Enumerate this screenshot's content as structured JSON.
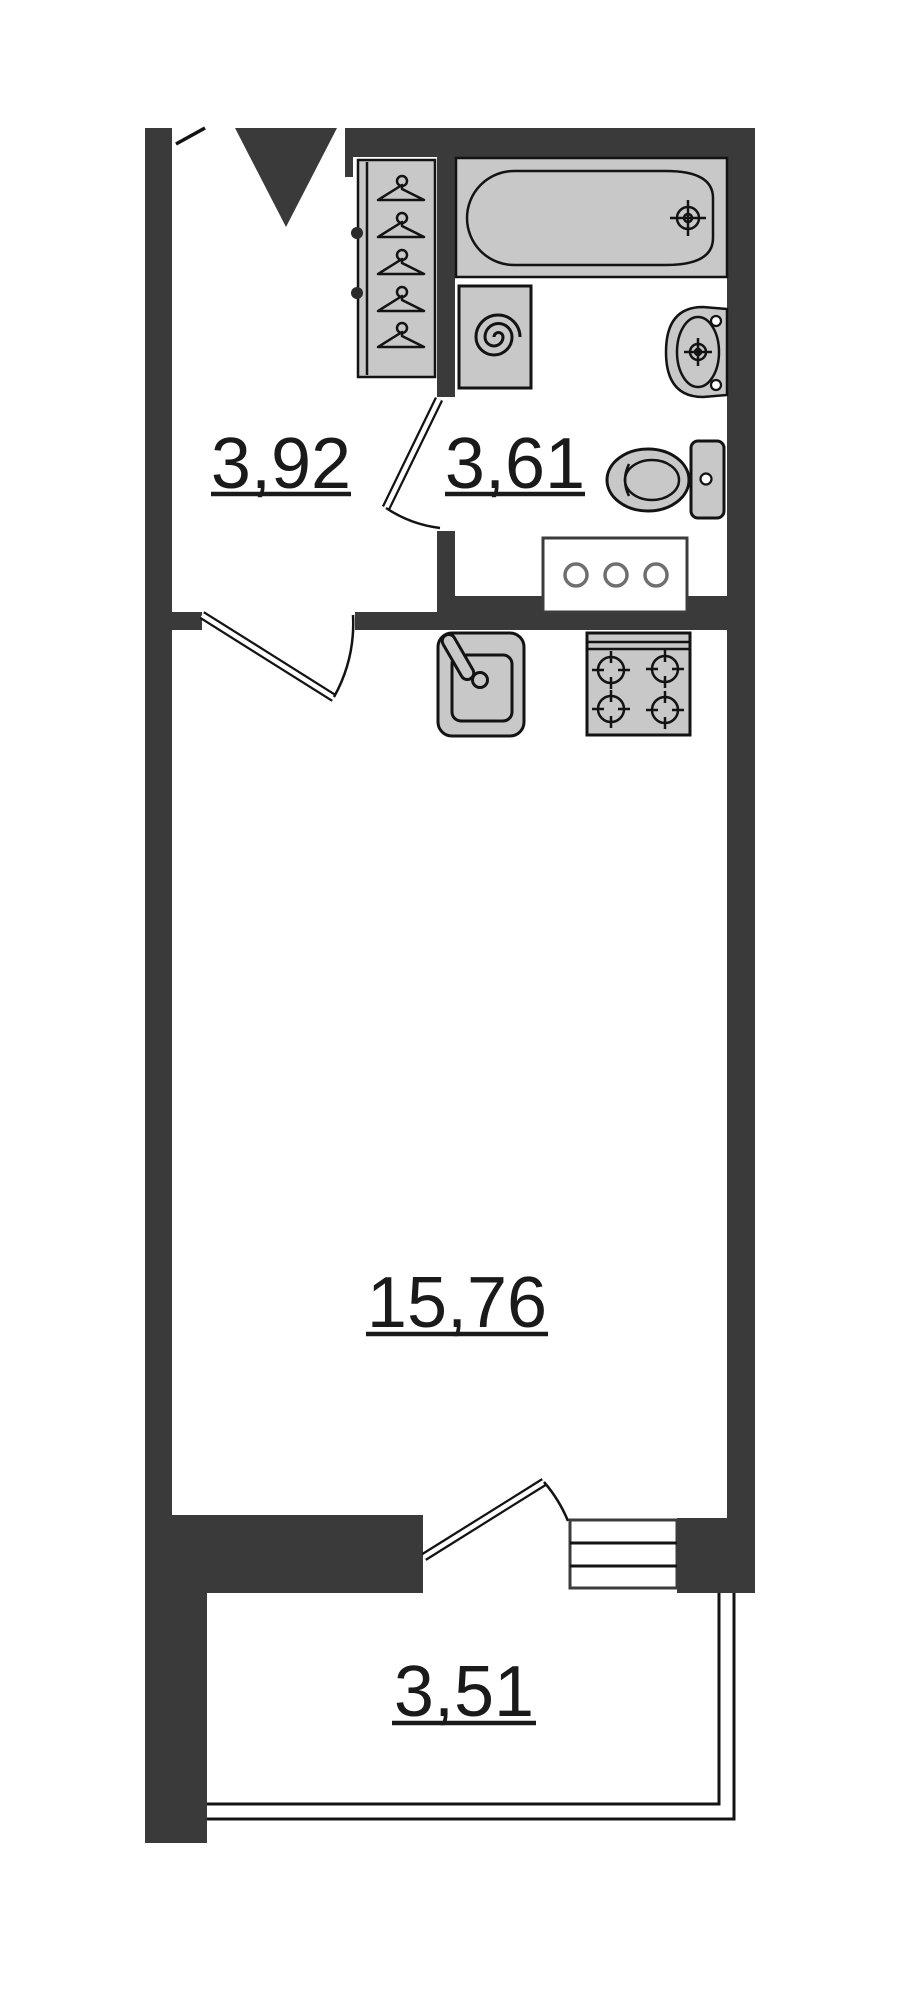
{
  "plan": {
    "kind": "studio apartment floor plan",
    "rooms": [
      {
        "name": "hallway",
        "area_label": "3,92"
      },
      {
        "name": "bathroom",
        "area_label": "3,61"
      },
      {
        "name": "living-room",
        "area_label": "15,76"
      },
      {
        "name": "balcony",
        "area_label": "3,51"
      }
    ],
    "fixtures": [
      "entrance-arrow",
      "entrance-door-leaf",
      "wardrobe-hangers",
      "bathtub",
      "washing-machine",
      "wash-basin",
      "toilet",
      "vanity-counter",
      "kitchen-sink",
      "cooktop",
      "balcony-window",
      "balcony-railing",
      "bathroom-door-swing",
      "living-room-door-swing",
      "balcony-door-swing"
    ],
    "colors": {
      "wall": "#3a3a3a",
      "fixture_fill": "#c8c8c8",
      "outline": "#131313",
      "background": "#ffffff",
      "label_text": "#1a1a1a"
    }
  }
}
